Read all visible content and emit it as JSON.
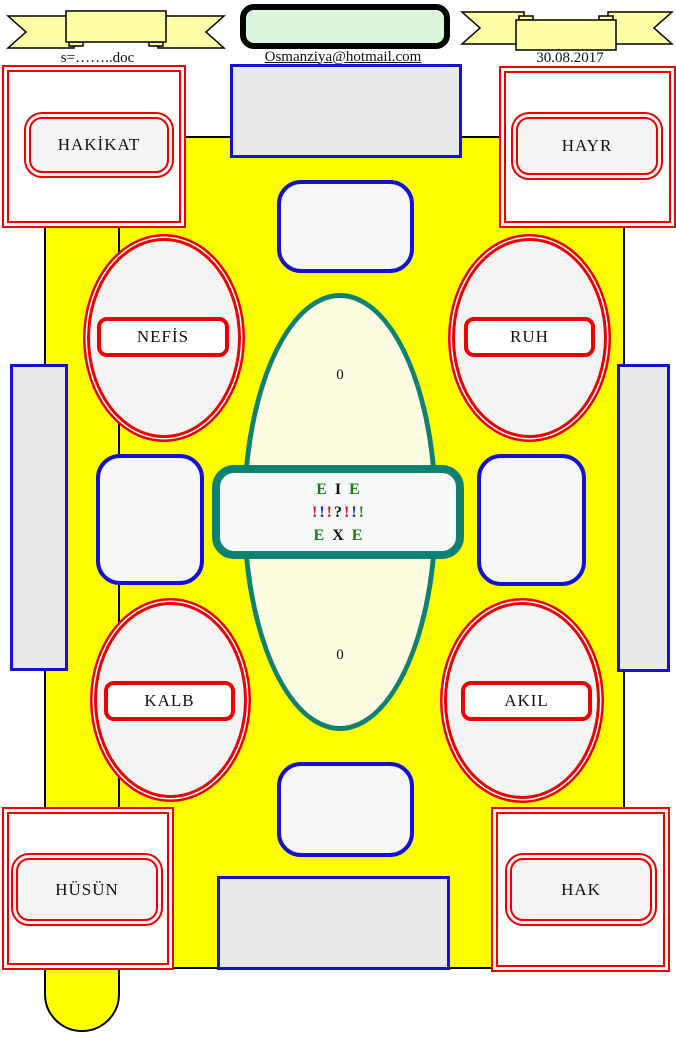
{
  "header": {
    "doc_label": "s=……..doc",
    "email": "Osmanziya@hotmail.com",
    "date": "30.08.2017",
    "banner_fill": "#ffffa8",
    "green_box_fill": "#dbf7db"
  },
  "corner_boxes": {
    "top_left": "HAKİKAT",
    "top_right": "HAYR",
    "bottom_left": "HÜSÜN",
    "bottom_right": "HAK"
  },
  "ellipse_labels": {
    "top_left": "NEFİS",
    "top_right": "RUH",
    "bottom_left": "KALB",
    "bottom_right": "AKIL"
  },
  "center": {
    "zero_top": "0",
    "zero_bottom": "0",
    "line1": [
      {
        "t": "E",
        "c": "#1a7a1a"
      },
      {
        "t": "I",
        "c": "#111111"
      },
      {
        "t": "E",
        "c": "#1a7a1a"
      }
    ],
    "line2": [
      {
        "t": "!",
        "c": "#e01010"
      },
      {
        "t": "!",
        "c": "#1818dd"
      },
      {
        "t": "!",
        "c": "#e01010"
      },
      {
        "t": "?",
        "c": "#111111"
      },
      {
        "t": "!",
        "c": "#e01010"
      },
      {
        "t": "!",
        "c": "#1818dd"
      },
      {
        "t": "!",
        "c": "#128a12"
      }
    ],
    "line3": [
      {
        "t": "E",
        "c": "#1a7a1a"
      },
      {
        "t": "X",
        "c": "#111111"
      },
      {
        "t": "E",
        "c": "#1a7a1a"
      }
    ]
  },
  "colors": {
    "main_yellow": "#ffff00",
    "teal": "#0f8173",
    "red": "#ee0000",
    "blue": "#1212cf",
    "gray_fill": "#e9e9e9",
    "ellipse_fill": "#fffde1"
  }
}
